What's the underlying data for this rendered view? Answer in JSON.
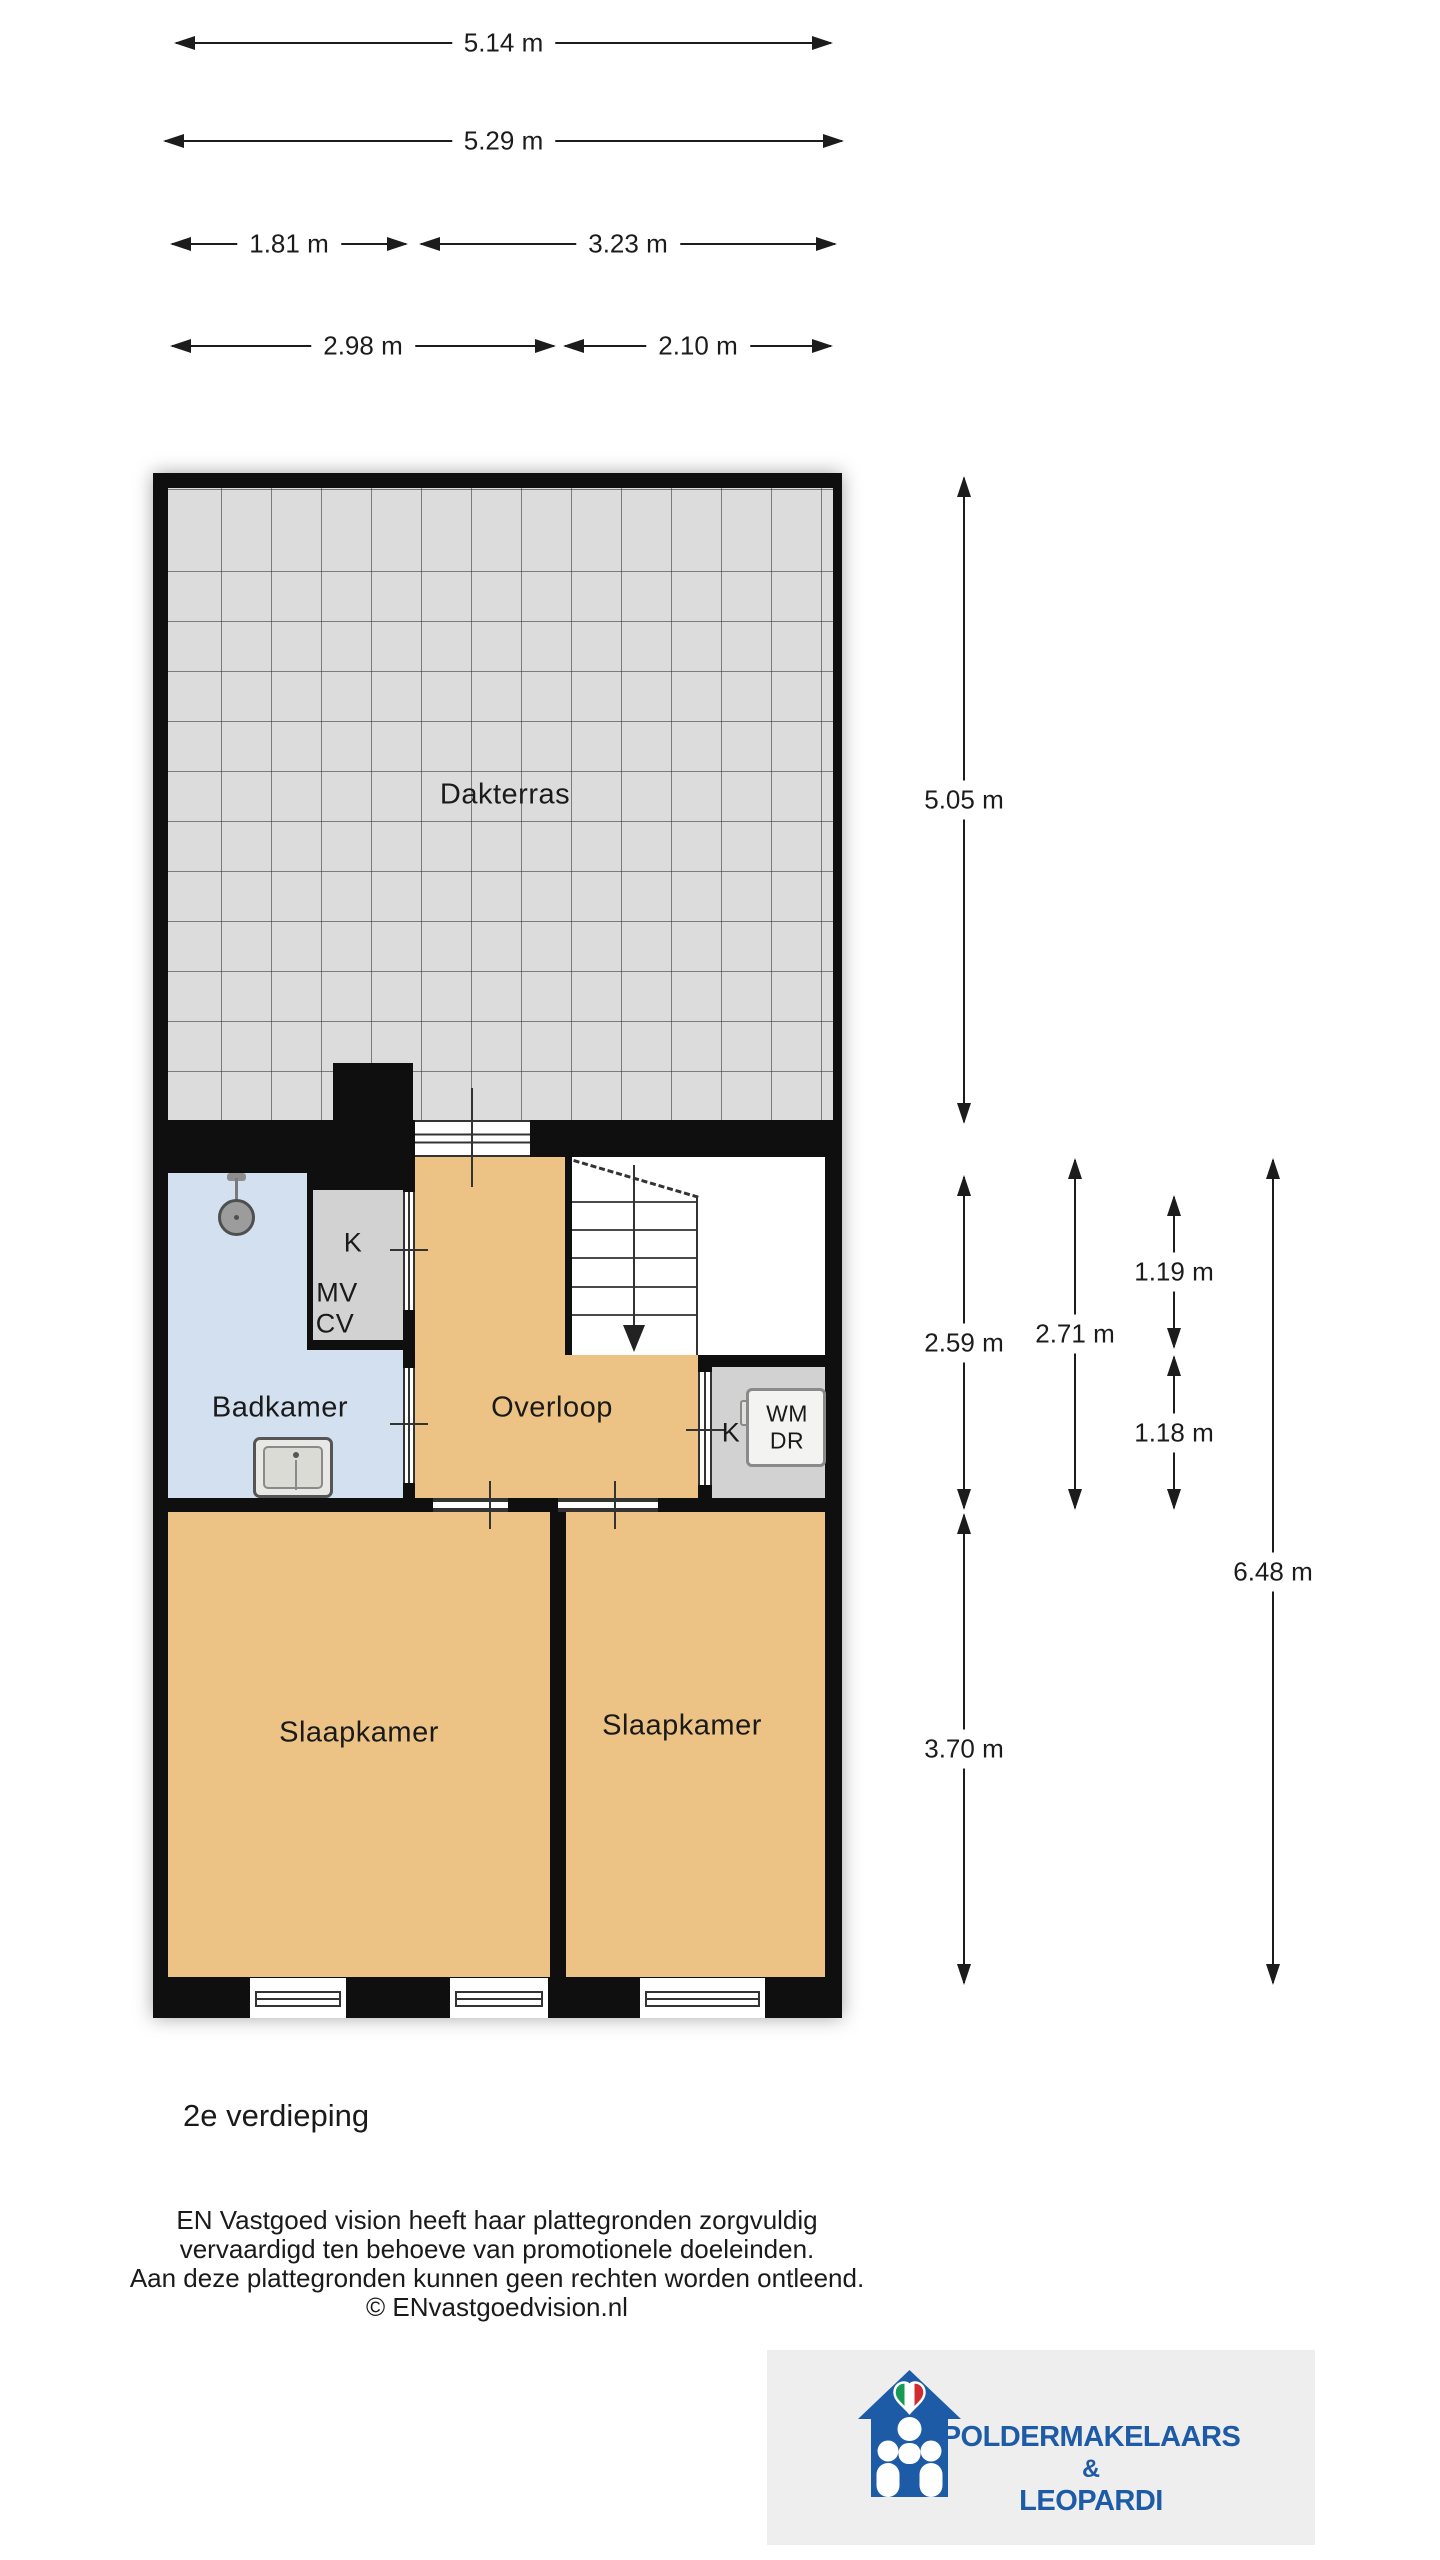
{
  "page": {
    "floor_label": "2e verdieping"
  },
  "plan": {
    "rooms": {
      "dakterras": "Dakterras",
      "badkamer": "Badkamer",
      "overloop": "Overloop",
      "slaapkamer_left": "Slaapkamer",
      "slaapkamer_right": "Slaapkamer"
    },
    "closet": {
      "k": "K",
      "mv": "MV",
      "cv": "CV"
    },
    "utility": {
      "k": "K",
      "wm": "WM",
      "dr": "DR"
    }
  },
  "dims": {
    "w_total": "5.14 m",
    "w_outer": "5.29 m",
    "w_left": "1.81 m",
    "w_right": "3.23 m",
    "w_bottom_left": "2.98 m",
    "w_bottom_right": "2.10 m",
    "h_dakterras": "5.05 m",
    "h_mid_left": "2.59 m",
    "h_mid": "2.71 m",
    "h_stair_top": "1.19 m",
    "h_stair_bottom": "1.18 m",
    "h_bedroom": "3.70 m",
    "h_total": "6.48 m"
  },
  "disclaimer": {
    "line1": "EN Vastgoed vision heeft haar plattegronden zorgvuldig",
    "line2": "vervaardigd ten behoeve van promotionele doeleinden.",
    "line3": "Aan deze plattegronden kunnen geen rechten worden ontleend.",
    "line4": "© ENvastgoedvision.nl"
  },
  "logo": {
    "name_top": "POLDERMAKELAARS",
    "ampersand": "&",
    "name_bottom": "LEOPARDI"
  },
  "colors": {
    "wall": "#0f0f0f",
    "terrace": "#dcdcdc",
    "orange": "#ecc384",
    "blue": "#d3e0ef",
    "gray": "#d2d2d2",
    "dimc": "#1c1c1c",
    "text": "#1a1a1a",
    "logo_blue": "#1d5ba6",
    "heart_green": "#169b52",
    "heart_red": "#d02c2f"
  }
}
